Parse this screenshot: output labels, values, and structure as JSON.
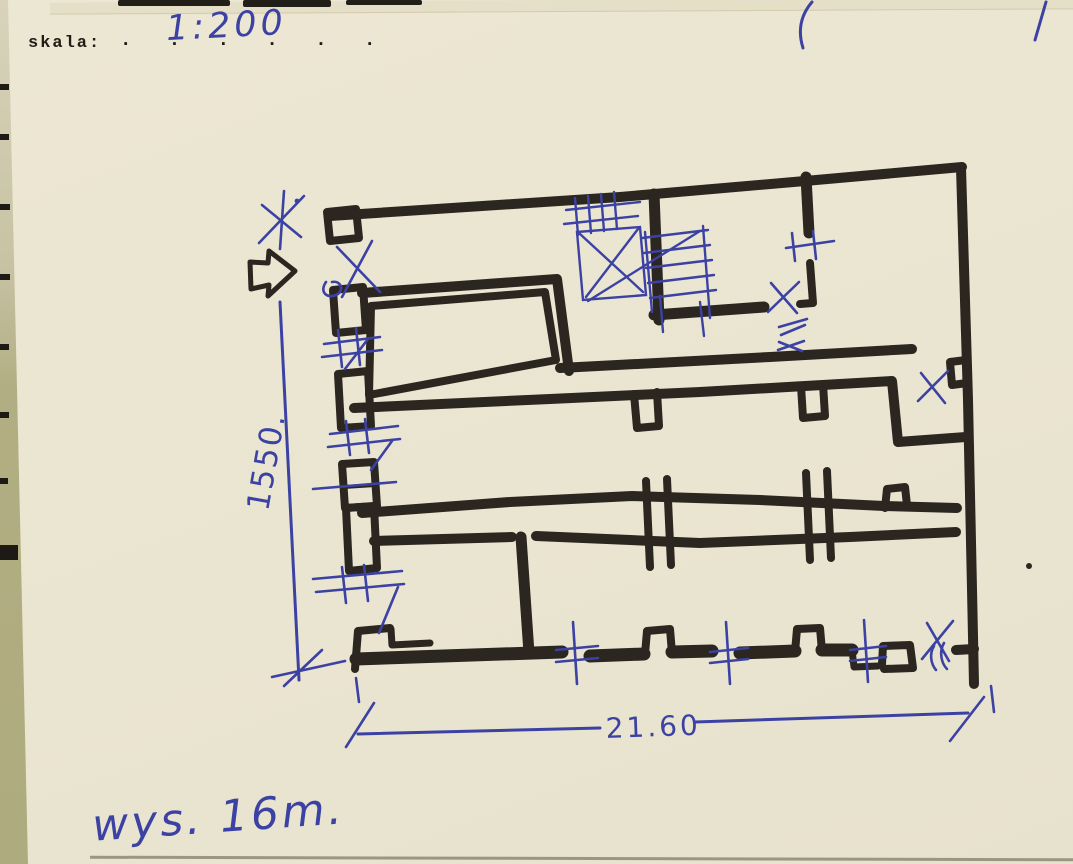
{
  "document": {
    "type_label": "skala:",
    "dotted_line": ". . . . . .",
    "scale_value": "1:200",
    "plan": {
      "dim_vertical": "1550.",
      "dim_horizontal": "21.60",
      "height_note": "wys. 16m."
    },
    "colors": {
      "paper": "#ebe6d3",
      "backing": "#b2ae83",
      "marker_black": "#2b2620",
      "pen_blue": "#3c42a3"
    },
    "symbols": {
      "north_arrow": "north-arrow-icon",
      "stairs": "stairs-symbol",
      "window_marks": "window-hatch-mark",
      "door_marks": "door-x-mark",
      "survey_mark": "survey-asterisk"
    }
  }
}
